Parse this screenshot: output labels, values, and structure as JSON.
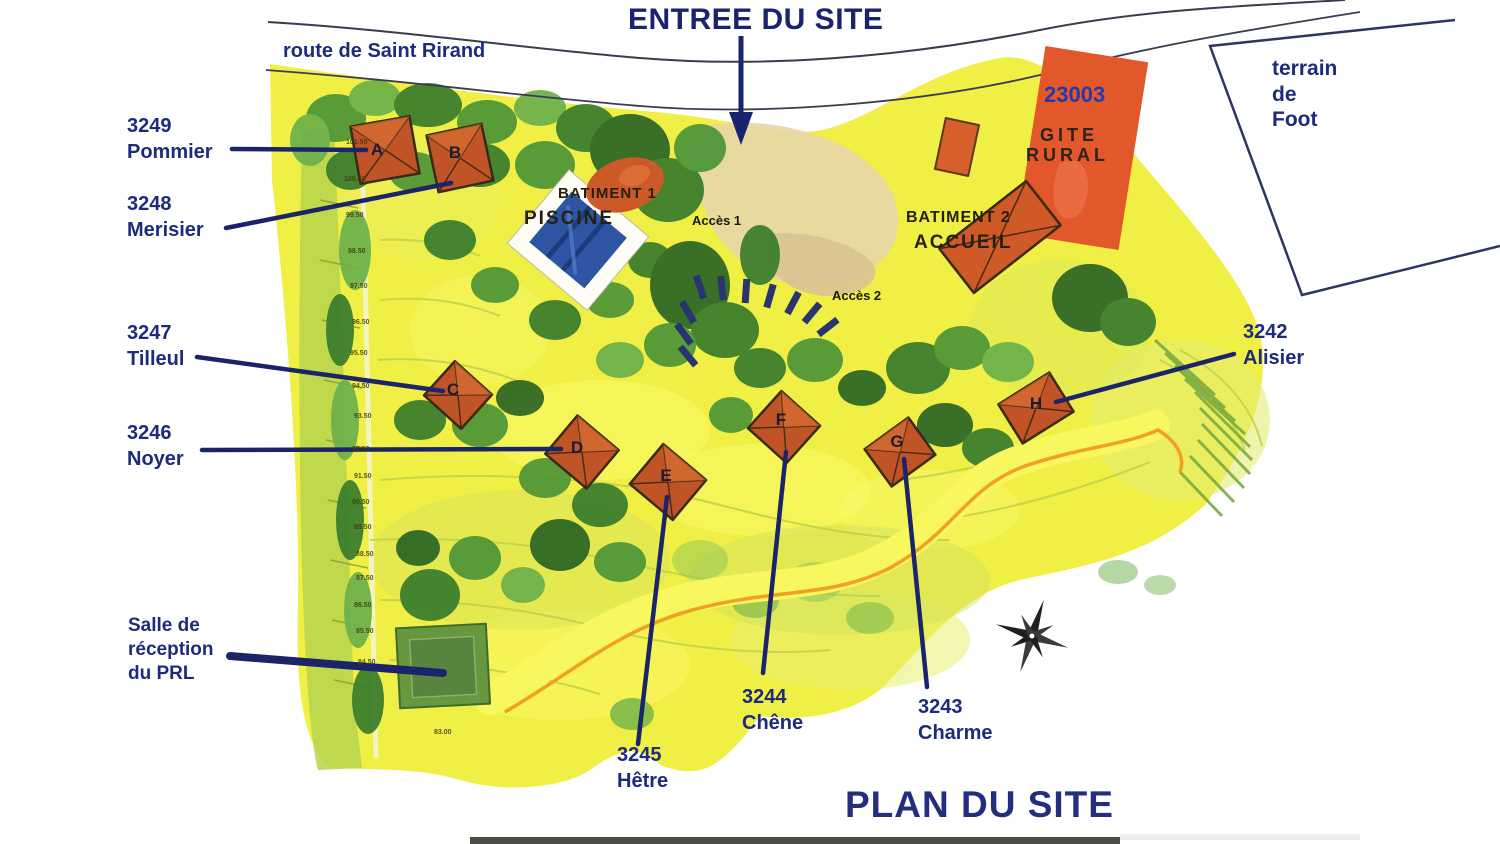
{
  "page": {
    "entrance_title": "ENTREE DU SITE",
    "plan_title": "PLAN DU SITE",
    "road_label": "route de Saint Rirand"
  },
  "football_field": {
    "line1": "terrain",
    "line2": "de",
    "line3": "Foot"
  },
  "gite_rural": {
    "code": "23003",
    "line1": "GITE",
    "line2": "RURAL"
  },
  "facilities": {
    "batiment1": "BATIMENT 1",
    "piscine": "PISCINE",
    "batiment2": "BATIMENT 2",
    "accueil": "ACCUEIL",
    "acces1": "Accès 1",
    "acces2": "Accès 2"
  },
  "reception": {
    "line1": "Salle de",
    "line2": "réception",
    "line3": "du PRL"
  },
  "cottages": [
    {
      "code": "3249",
      "tree": "Pommier",
      "letter": "A"
    },
    {
      "code": "3248",
      "tree": "Merisier",
      "letter": "B"
    },
    {
      "code": "3247",
      "tree": "Tilleul",
      "letter": "C"
    },
    {
      "code": "3246",
      "tree": "Noyer",
      "letter": "D"
    },
    {
      "code": "3245",
      "tree": "Hêtre",
      "letter": "E"
    },
    {
      "code": "3244",
      "tree": "Chêne",
      "letter": "F"
    },
    {
      "code": "3243",
      "tree": "Charme",
      "letter": "G"
    },
    {
      "code": "3242",
      "tree": "Alisier",
      "letter": "H"
    }
  ],
  "elevations": [
    "101.50",
    "100.50",
    "99.50",
    "98.50",
    "97.50",
    "96.50",
    "95.50",
    "94.50",
    "93.50",
    "92.50",
    "91.50",
    "90.50",
    "89.50",
    "88.50",
    "87.50",
    "86.50",
    "85.50",
    "84.50",
    "83.00"
  ],
  "colors": {
    "label_navy": "#1c2b7d",
    "building_orange": "#c05426",
    "gite_orange": "#e2582a",
    "pool_blue": "#2e55a4",
    "path_orange": "#f0a024",
    "map_yellow": "#f0ef45",
    "tree_green": "#4e9637"
  }
}
